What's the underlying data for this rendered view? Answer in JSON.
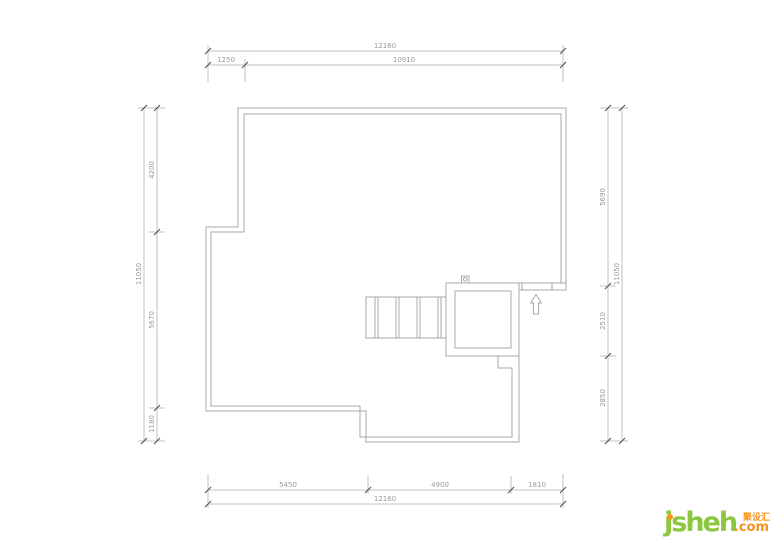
{
  "plan": {
    "dims": {
      "top": {
        "total": "12160",
        "segments": [
          "1250",
          "10910"
        ]
      },
      "bottom": {
        "total": "12160",
        "segments": [
          "5450",
          "4900",
          "1810"
        ]
      },
      "left": {
        "total": "11050",
        "segments": [
          "4200",
          "5670",
          "1180"
        ]
      },
      "right": {
        "total": "11050",
        "segments": [
          "5690",
          "2510",
          "2850"
        ]
      }
    },
    "colors": {
      "wall": "#a8a8a8",
      "dim_line": "#c2c2c2",
      "dim_text": "#9a9a9a",
      "tick": "#4d4d4d"
    },
    "features": {
      "staircase": "staircase",
      "stair_core": "stair-core-room",
      "entry_arrow": "entry-direction-arrow",
      "door_symbol": "door-symbol"
    }
  },
  "logo": {
    "brand": "jsheh",
    "domain_suffix": ".com",
    "chinese_name": "聚设汇",
    "brand_green": "#8dc63f",
    "brand_orange": "#f7941e"
  }
}
